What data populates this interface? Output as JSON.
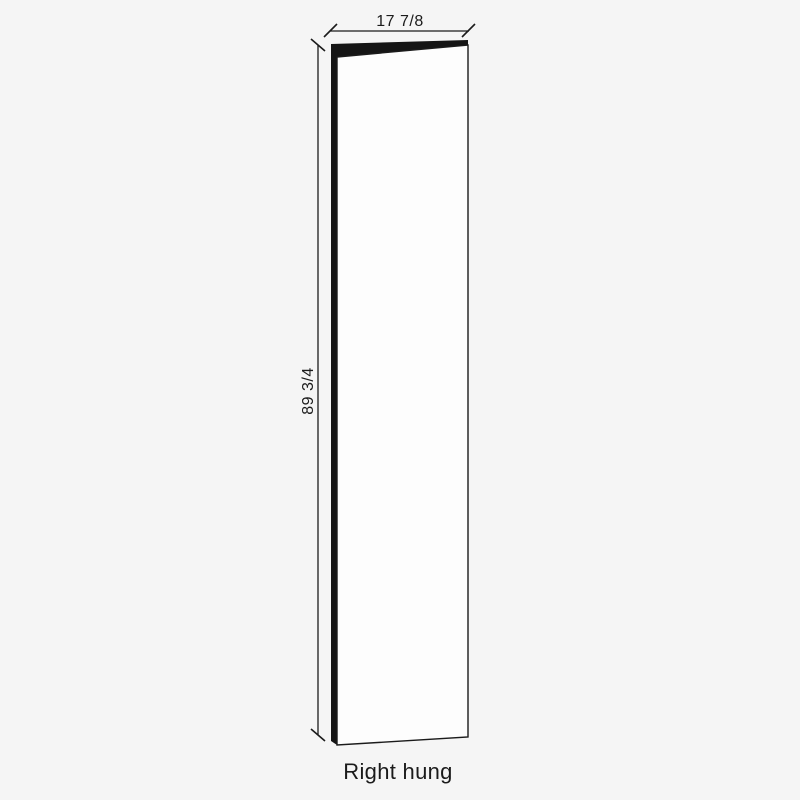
{
  "diagram": {
    "type": "door-panel-dimension-drawing",
    "caption": "Right hung",
    "width": {
      "label": "17 7/8"
    },
    "height": {
      "label": "89 3/4"
    }
  },
  "colors": {
    "background": "#f5f5f5",
    "door_face": "#fdfdfd",
    "ink": "#1b1b1b"
  }
}
